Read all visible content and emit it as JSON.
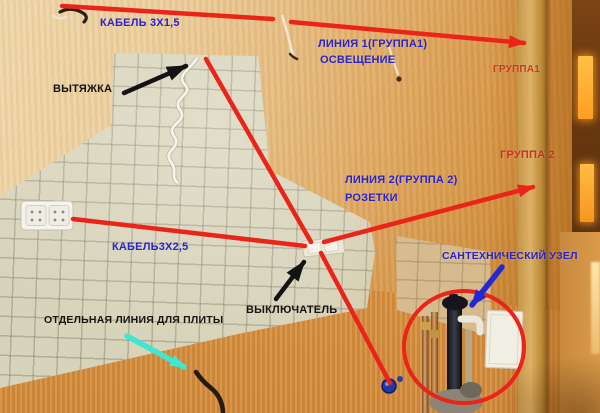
{
  "annotations": {
    "cable_1_5": "КАБЕЛЬ 3Х1,5",
    "line1": "ЛИНИЯ 1(ГРУППА1)",
    "line1_sub": "ОСВЕЩЕНИЕ",
    "group1": "ГРУППА1",
    "hood": "ВЫТЯЖКА",
    "group2": "ГРУППА 2",
    "line2": "ЛИНИЯ 2(ГРУППА 2)",
    "line2_sub": "РОЗЕТКИ",
    "cable_2_5": "КАБЕЛЬ3Х2,5",
    "switch_label": "ВЫКЛЮЧАТЕЛЬ",
    "stove_line": "ОТДЕЛЬНАЯ ЛИНИЯ ДЛЯ ПЛИТЫ",
    "plumbing_unit": "САНТЕХНИЧЕСКИЙ УЗЕЛ"
  },
  "colors": {
    "wire_line_red": "#ea2418",
    "label_blue": "#2823cc",
    "label_red": "#c5321f",
    "label_black": "#141414",
    "stove_arrow_cyan": "#3fe6d0",
    "plumbing_arrow_blue": "#2229d4",
    "tile_beige": "#d7d3ba",
    "wallpaper_orange": "#dda45c"
  }
}
